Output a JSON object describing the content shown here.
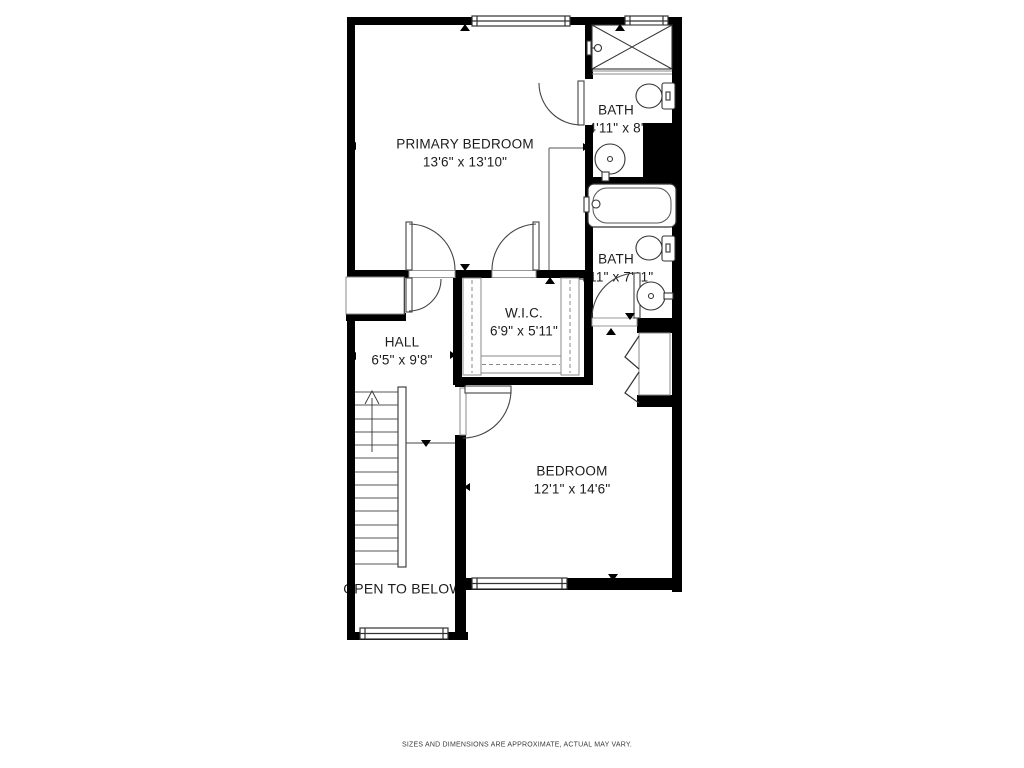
{
  "plan": {
    "title": "second-floor-plan",
    "rooms": [
      {
        "id": "primary-bedroom",
        "name": "PRIMARY BEDROOM",
        "dims": "13'6\" x 13'10\""
      },
      {
        "id": "bath-top",
        "name": "BATH",
        "dims": "4'11\" x 8'"
      },
      {
        "id": "bath-middle",
        "name": "BATH",
        "dims": "4'11\" x 7'11\""
      },
      {
        "id": "walk-in-closet",
        "name": "W.I.C.",
        "dims": "6'9\" x 5'11\""
      },
      {
        "id": "hall",
        "name": "HALL",
        "dims": "6'5\" x 9'8\""
      },
      {
        "id": "bedroom",
        "name": "BEDROOM",
        "dims": "12'1\" x 14'6\""
      },
      {
        "id": "open-to-below",
        "name": "OPEN TO BELOW",
        "dims": ""
      }
    ],
    "disclaimer": "SIZES AND DIMENSIONS ARE APPROXIMATE, ACTUAL MAY VARY.",
    "colors": {
      "wall": "#000000",
      "line": "#444444",
      "thin": "#888888",
      "background": "#ffffff"
    },
    "fixtures": [
      "shower",
      "toilet",
      "sink",
      "bathtub",
      "stairs",
      "bifold-closet-doors",
      "closet-rods",
      "windows",
      "door-swings"
    ]
  }
}
